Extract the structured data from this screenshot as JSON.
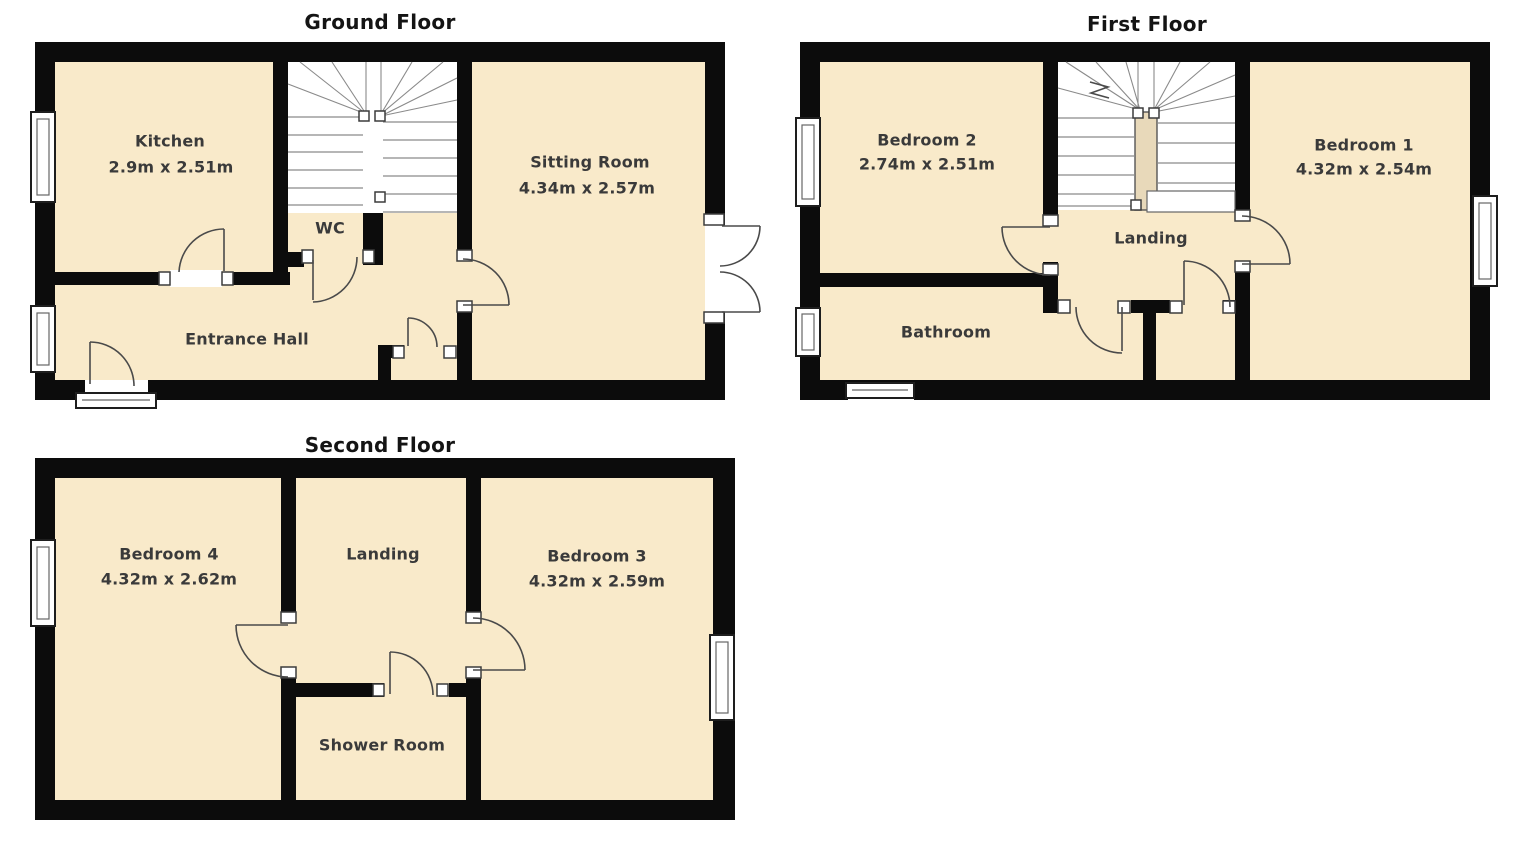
{
  "document_type": "Property floorplan, 3 storeys",
  "colors": {
    "floor_fill": "#F9EACA",
    "wall": "#0C0C0C",
    "background": "#FFFFFF",
    "label_text": "#3A3A3A",
    "title_text": "#141414"
  },
  "floors": [
    {
      "title": "Ground Floor",
      "rooms": [
        {
          "name": "Kitchen",
          "dims": "2.9m x 2.51m"
        },
        {
          "name": "WC",
          "dims": ""
        },
        {
          "name": "Sitting Room",
          "dims": "4.34m x 2.57m"
        },
        {
          "name": "Entrance Hall",
          "dims": ""
        }
      ]
    },
    {
      "title": "First Floor",
      "rooms": [
        {
          "name": "Bedroom 2",
          "dims": "2.74m x 2.51m"
        },
        {
          "name": "Bedroom 1",
          "dims": "4.32m x 2.54m"
        },
        {
          "name": "Landing",
          "dims": ""
        },
        {
          "name": "Bathroom",
          "dims": ""
        }
      ]
    },
    {
      "title": "Second Floor",
      "rooms": [
        {
          "name": "Bedroom 4",
          "dims": "4.32m x 2.62m"
        },
        {
          "name": "Landing",
          "dims": ""
        },
        {
          "name": "Bedroom 3",
          "dims": "4.32m x 2.59m"
        },
        {
          "name": "Shower Room",
          "dims": ""
        }
      ]
    }
  ]
}
